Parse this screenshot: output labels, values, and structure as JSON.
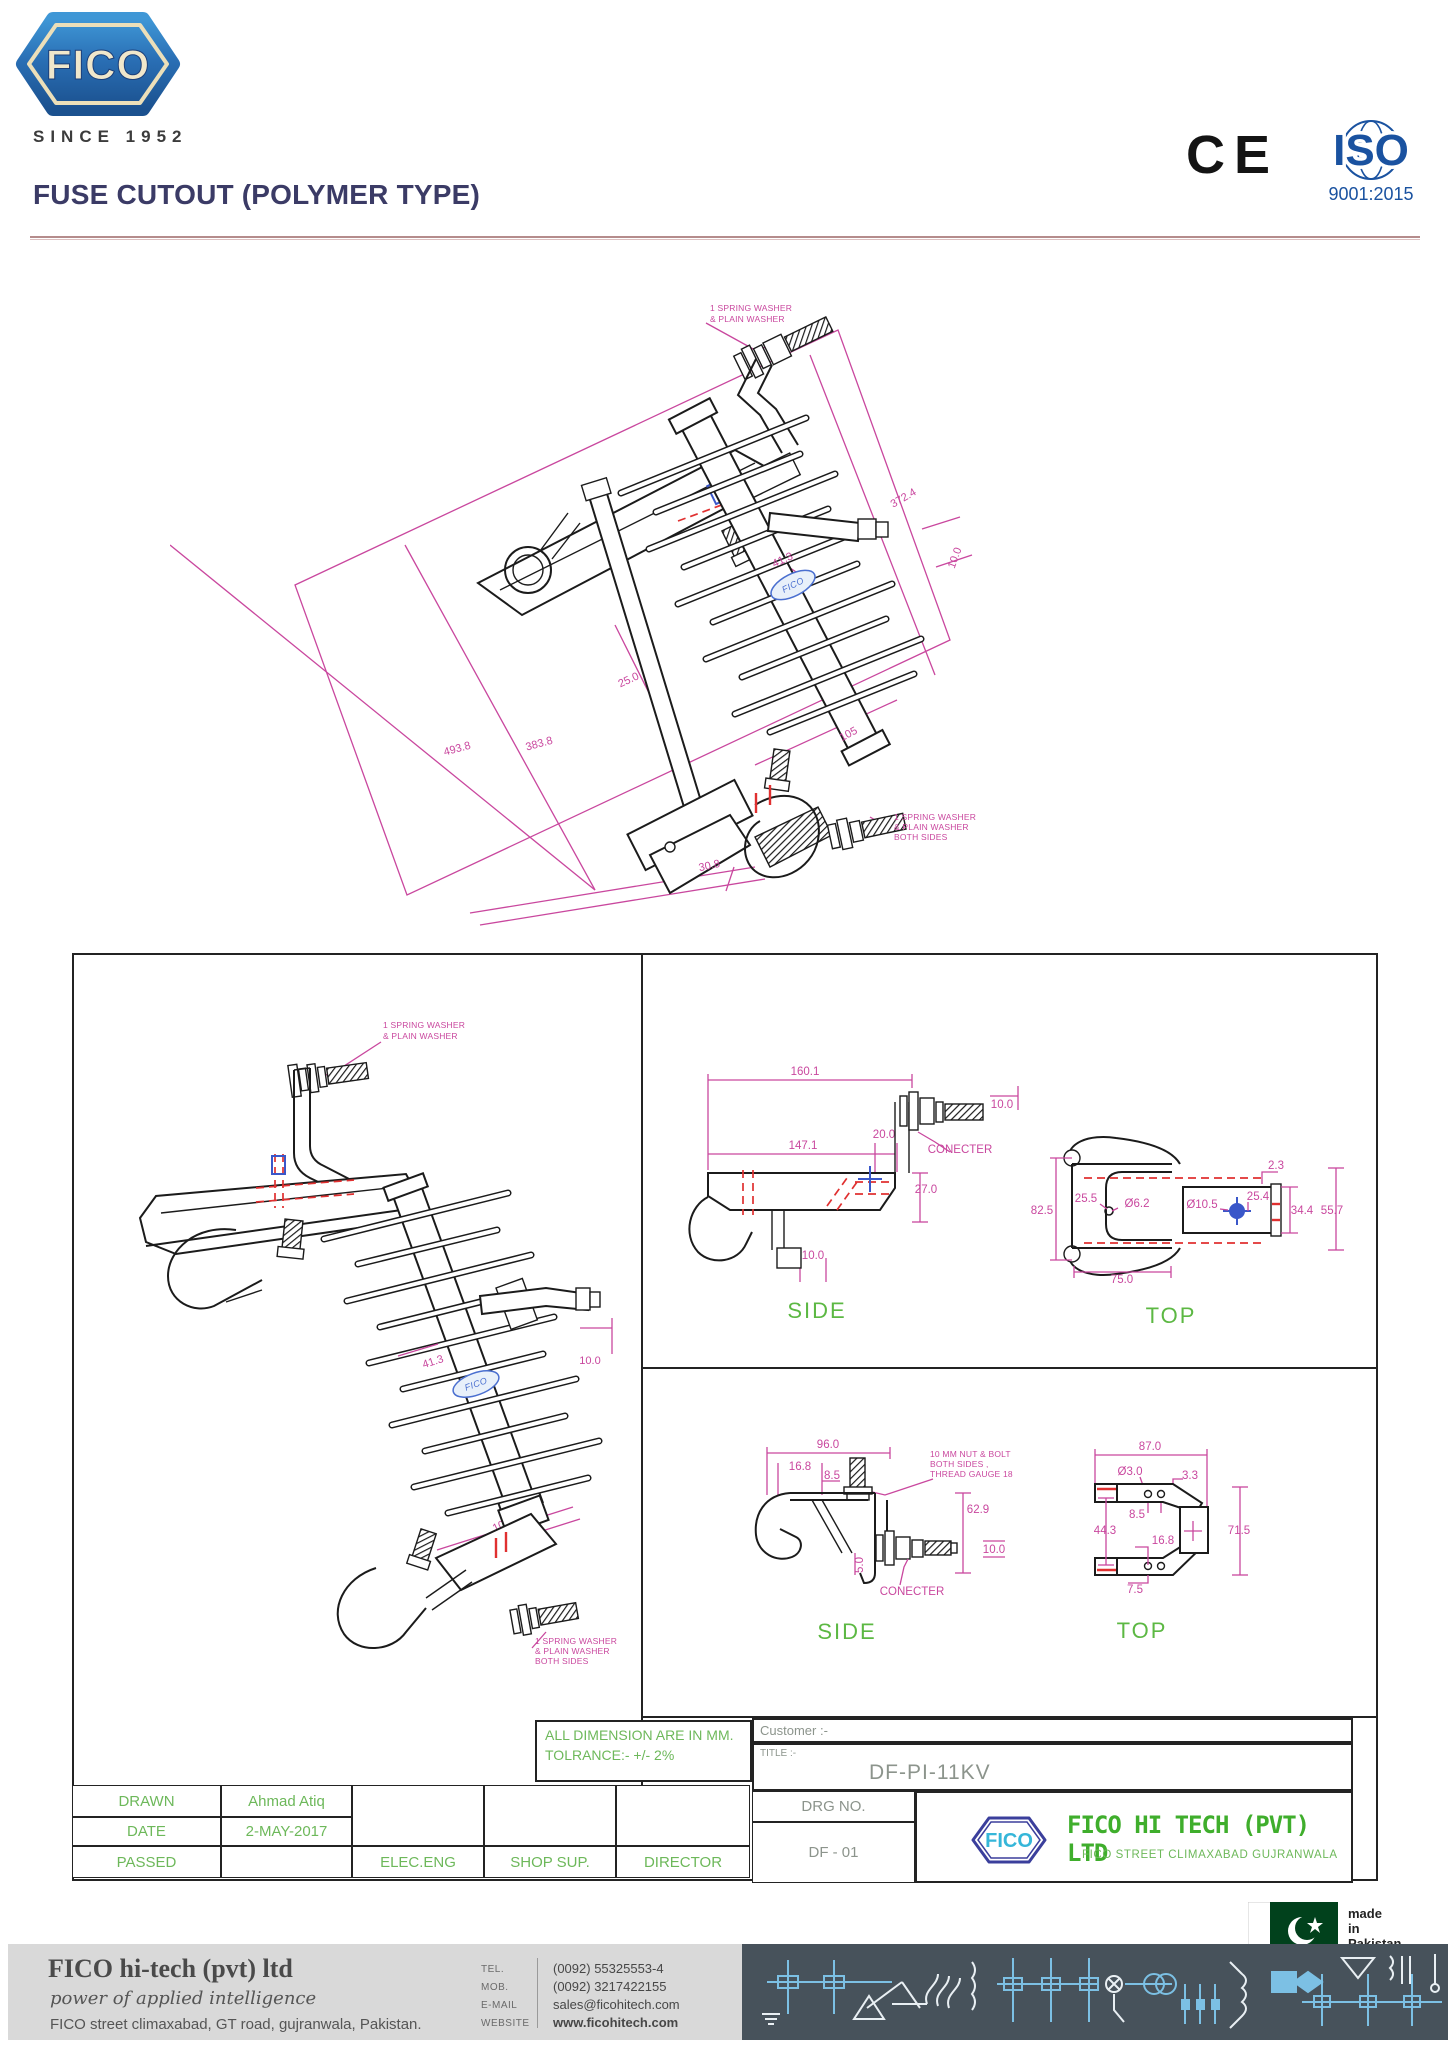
{
  "header": {
    "brand": "FICO",
    "since": "SINCE 1952",
    "title": "FUSE CUTOUT (POLYMER TYPE)",
    "ce": "CE",
    "iso": "ISO",
    "iso_sub": "9001:2015"
  },
  "iso_view": {
    "note_top_1": "1 SPRING WASHER",
    "note_top_2": "& PLAIN WASHER",
    "dim_overall": "372.4",
    "dim_terminal": "10.0",
    "dim_insulator": "41.3",
    "dim_tube": "25.0",
    "dim_height_inner": "383.8",
    "dim_height_outer": "493.8",
    "dim_sheds": "105",
    "dim_base": "30.8",
    "note_bottom_1": "1 SPRING WASHER",
    "note_bottom_2": "& PLAIN WASHER",
    "note_bottom_3": "BOTH SIDES",
    "brand": "FICO"
  },
  "front_view": {
    "note_top_1": "1 SPRING WASHER",
    "note_top_2": "& PLAIN WASHER",
    "dim_insulator": "41.3",
    "dim_terminal": "10.0",
    "dim_sheds": "105",
    "note_bottom_1": "1 SPRING WASHER",
    "note_bottom_2": "& PLAIN WASHER",
    "note_bottom_3": "BOTH SIDES",
    "brand": "FICO"
  },
  "side_view_upper": {
    "dim_width_total": "160.1",
    "dim_bolt": "10.0",
    "dim_offset": "20.0",
    "dim_width_inner": "147.1",
    "connector_label": "CONECTER",
    "dim_height": "27.0",
    "dim_foot": "10.0",
    "label": "SIDE"
  },
  "top_view_upper": {
    "dim_height_total": "82.5",
    "dim_hole_offset": "25.5",
    "dia_small": "Ø6.2",
    "dia_large": "Ø10.5",
    "dim_hole_offset2": "25.4",
    "dim_plate": "2.3",
    "dim_inner": "34.4",
    "dim_outer": "55.7",
    "dim_width": "75.0",
    "label": "TOP"
  },
  "side_view_lower": {
    "dim_width_total": "96.0",
    "dim_hook": "16.8",
    "dim_step": "8.5",
    "note_1": "10 MM NUT & BOLT",
    "note_2": "BOTH SIDES ,",
    "note_3": "THREAD GAUGE 18",
    "dim_height": "62.9",
    "dim_bolt": "10.0",
    "dim_foot": "5.0",
    "connector_label": "CONECTER",
    "label": "SIDE"
  },
  "top_view_lower": {
    "dim_width_total": "87.0",
    "dia_hole": "Ø3.0",
    "dim_lip": "3.3",
    "dim_hole_gap": "8.5",
    "dim_height_inner": "44.3",
    "dim_hole_offset": "16.8",
    "dim_height_total": "71.5",
    "dim_tab": "7.5",
    "label": "TOP"
  },
  "title_block": {
    "note_line1": "ALL DIMENSION ARE IN MM.",
    "note_line2": "TOLRANCE:- +/- 2%",
    "drawn_label": "DRAWN",
    "drawn_value": "Ahmad Atiq",
    "date_label": "DATE",
    "date_value": "2-MAY-2017",
    "passed_label": "PASSED",
    "sig_1": "ELEC.ENG",
    "sig_2": "SHOP SUP.",
    "sig_3": "DIRECTOR",
    "customer_label": "Customer :-",
    "title_label": "TITLE :-",
    "title_value": "DF-PI-11KV",
    "drg_label": "DRG NO.",
    "drg_value": "DF - 01",
    "company_logo": "FICO",
    "company_name": "FICO HI TECH (PVT) LTD",
    "company_address": "FICO STREET CLIMAXABAD GUJRANWALA"
  },
  "made_in": {
    "l1": "made",
    "l2": "in",
    "l3": "Pakistan"
  },
  "footer": {
    "company": "FICO hi-tech (pvt) ltd",
    "tagline": "power of applied intelligence",
    "address": "FICO street climaxabad, GT road, gujranwala, Pakistan.",
    "contacts": [
      {
        "label": "TEL.",
        "value": "(0092) 55325553-4"
      },
      {
        "label": "MOB.",
        "value": "(0092) 3217422155"
      },
      {
        "label": "E-MAIL",
        "value": "sales@ficohitech.com"
      },
      {
        "label": "WEBSITE",
        "value": "www.ficohitech.com"
      }
    ]
  },
  "colors": {
    "dimension_pink": "#c9479e",
    "drawing_black": "#1b1b1b",
    "accent_green": "#5cb843",
    "title_navy": "#3b3b66",
    "iso_blue": "#1a52a0",
    "logo_blue": "#2a6fb5",
    "footer_dark": "#47525b",
    "schematic_blue": "#7cc0e4"
  }
}
